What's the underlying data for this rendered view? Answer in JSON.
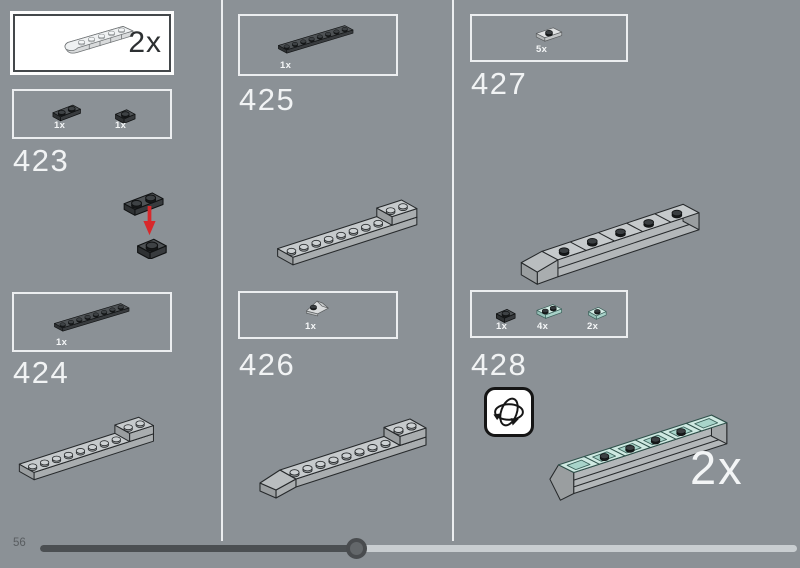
{
  "preview": {
    "count": "2x",
    "part": "curved-slope-brick-light"
  },
  "steps": {
    "s423": {
      "number": "423",
      "parts": [
        {
          "count": "1x",
          "part": "plate-1x2-dark"
        },
        {
          "count": "1x",
          "part": "plate-1x1-dark"
        }
      ]
    },
    "s424": {
      "number": "424",
      "parts": [
        {
          "count": "1x",
          "part": "plate-1x8-dark"
        }
      ]
    },
    "s425": {
      "number": "425",
      "parts": [
        {
          "count": "1x",
          "part": "plate-1x8-dark"
        }
      ]
    },
    "s426": {
      "number": "426",
      "parts": [
        {
          "count": "1x",
          "part": "slope-wedge-light"
        }
      ]
    },
    "s427": {
      "number": "427",
      "parts": [
        {
          "count": "5x",
          "part": "jumper-plate-1x2-light"
        }
      ]
    },
    "s428": {
      "number": "428",
      "parts": [
        {
          "count": "1x",
          "part": "plate-1x1-dark"
        },
        {
          "count": "4x",
          "part": "plate-1x2-teal"
        },
        {
          "count": "2x",
          "part": "plate-1x1-teal"
        }
      ],
      "multiplier": "2x"
    }
  },
  "footer": {
    "page_number": "56",
    "progress_fraction": 0.418
  },
  "colors": {
    "background": "#8b9196",
    "divider": "#eceef0",
    "callout_border": "#eceef0",
    "accent_red": "#d8282b",
    "dark_piece": "#4e5255",
    "teal_piece": "#cfe9e2",
    "light_piece": "#eff1f2",
    "step_text": "#f1f3f4",
    "track_filled": "#4b4f52",
    "track_empty": "#c9ced1"
  }
}
